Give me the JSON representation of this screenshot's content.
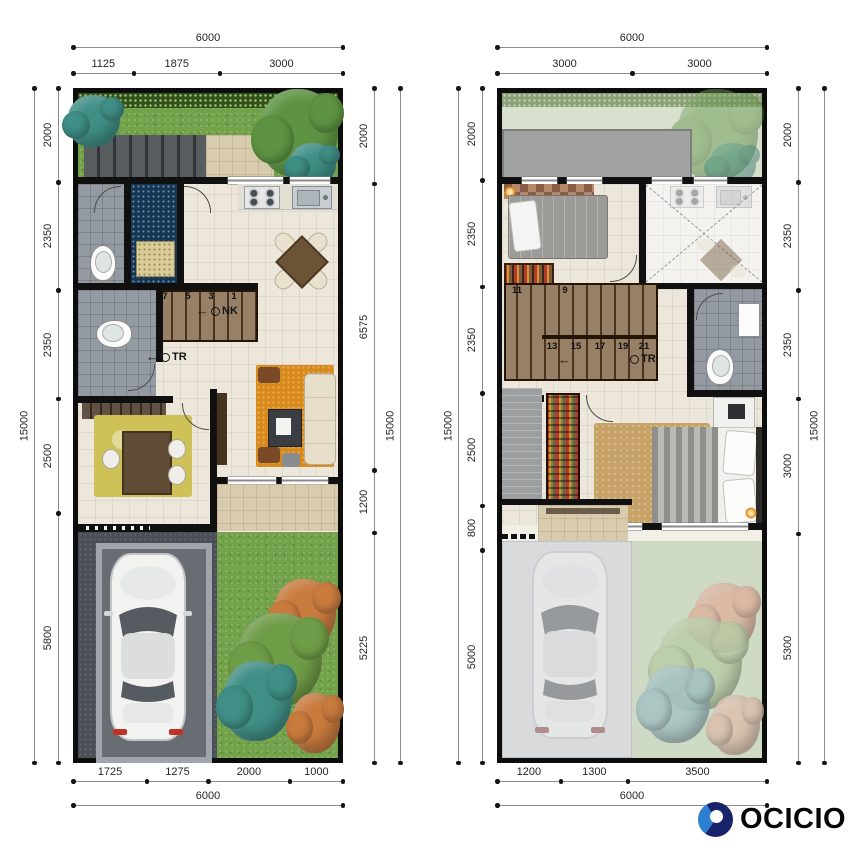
{
  "logo": {
    "text": "OCICIO"
  },
  "ground_floor": {
    "dims": {
      "top_total": "6000",
      "top_segments": [
        "1125",
        "1875",
        "3000"
      ],
      "bottom_segments": [
        "1725",
        "1275",
        "2000",
        "1000"
      ],
      "bottom_total": "6000",
      "left_total": "15000",
      "left_segments": [
        "2000",
        "2350",
        "2350",
        "2500",
        "5800"
      ],
      "right_segments": [
        "2000",
        "6575",
        "1200",
        "5225"
      ],
      "right_total": "15000"
    },
    "stairs": {
      "numbers": [
        "7",
        "5",
        "3",
        "1"
      ],
      "up_label": "NK",
      "down_label": "TR"
    }
  },
  "upper_floor": {
    "dims": {
      "top_total": "6000",
      "top_segments": [
        "3000",
        "3000"
      ],
      "bottom_segments": [
        "1200",
        "1300",
        "3500"
      ],
      "bottom_total": "6000",
      "left_total": "15000",
      "left_segments": [
        "2000",
        "2350",
        "2350",
        "2500",
        "800",
        "5000"
      ],
      "right_segments": [
        "2000",
        "2350",
        "2350",
        "3000",
        "5300"
      ],
      "right_total": "15000"
    },
    "stairs": {
      "numbers_upper": [
        "11",
        "9"
      ],
      "numbers_lower": [
        "13",
        "15",
        "17",
        "19",
        "21"
      ],
      "down_label": "TR"
    }
  },
  "colors": {
    "wall": "#101010",
    "accent_blue": "#2d7fd2",
    "navy": "#18236b",
    "grass": "#74a24b",
    "stair_wood": "#8a6f52",
    "rug_orange": "#d8891c",
    "rug_yellow": "#cec158"
  }
}
